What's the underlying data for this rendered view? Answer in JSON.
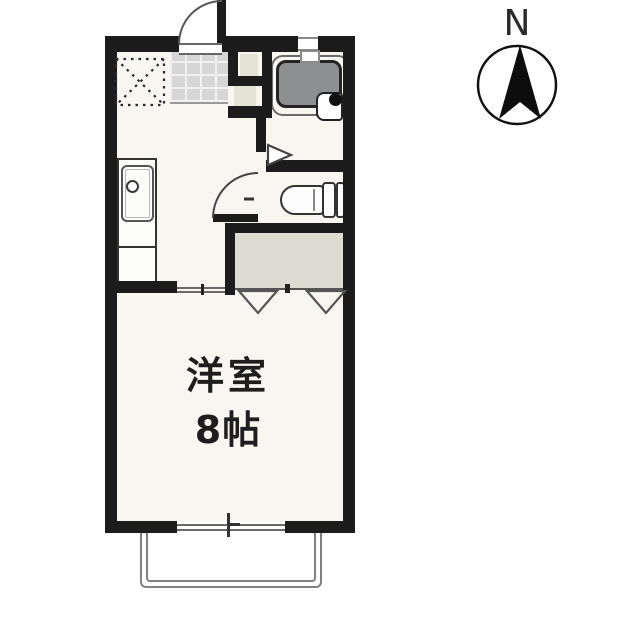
{
  "compass": {
    "label": "N"
  },
  "main_room": {
    "name": "洋室",
    "size": "8帖"
  },
  "colors": {
    "wall": "#1c1c1c",
    "floor": "#f7f6f1",
    "tile_fill": "#d6d6d6",
    "beige_fill": "#e4e4d6",
    "closet_fill": "#dcddd0",
    "bathtub_fill": "#8e8f90",
    "balcony_line": "#808080",
    "thin_line": "#555555"
  },
  "legend": {
    "bathtub": "bathtub",
    "bathroom_sink": "wash basin",
    "toilet": "toilet",
    "kitchen_sink": "kitchen sink with counter",
    "refrigerator_space": "refrigerator space (dashed box)",
    "entrance": "genkan tiled entrance with outward-swinging door",
    "closet": "closet with folding doors",
    "balcony": "balcony below sliding window",
    "compass": "north arrow"
  }
}
